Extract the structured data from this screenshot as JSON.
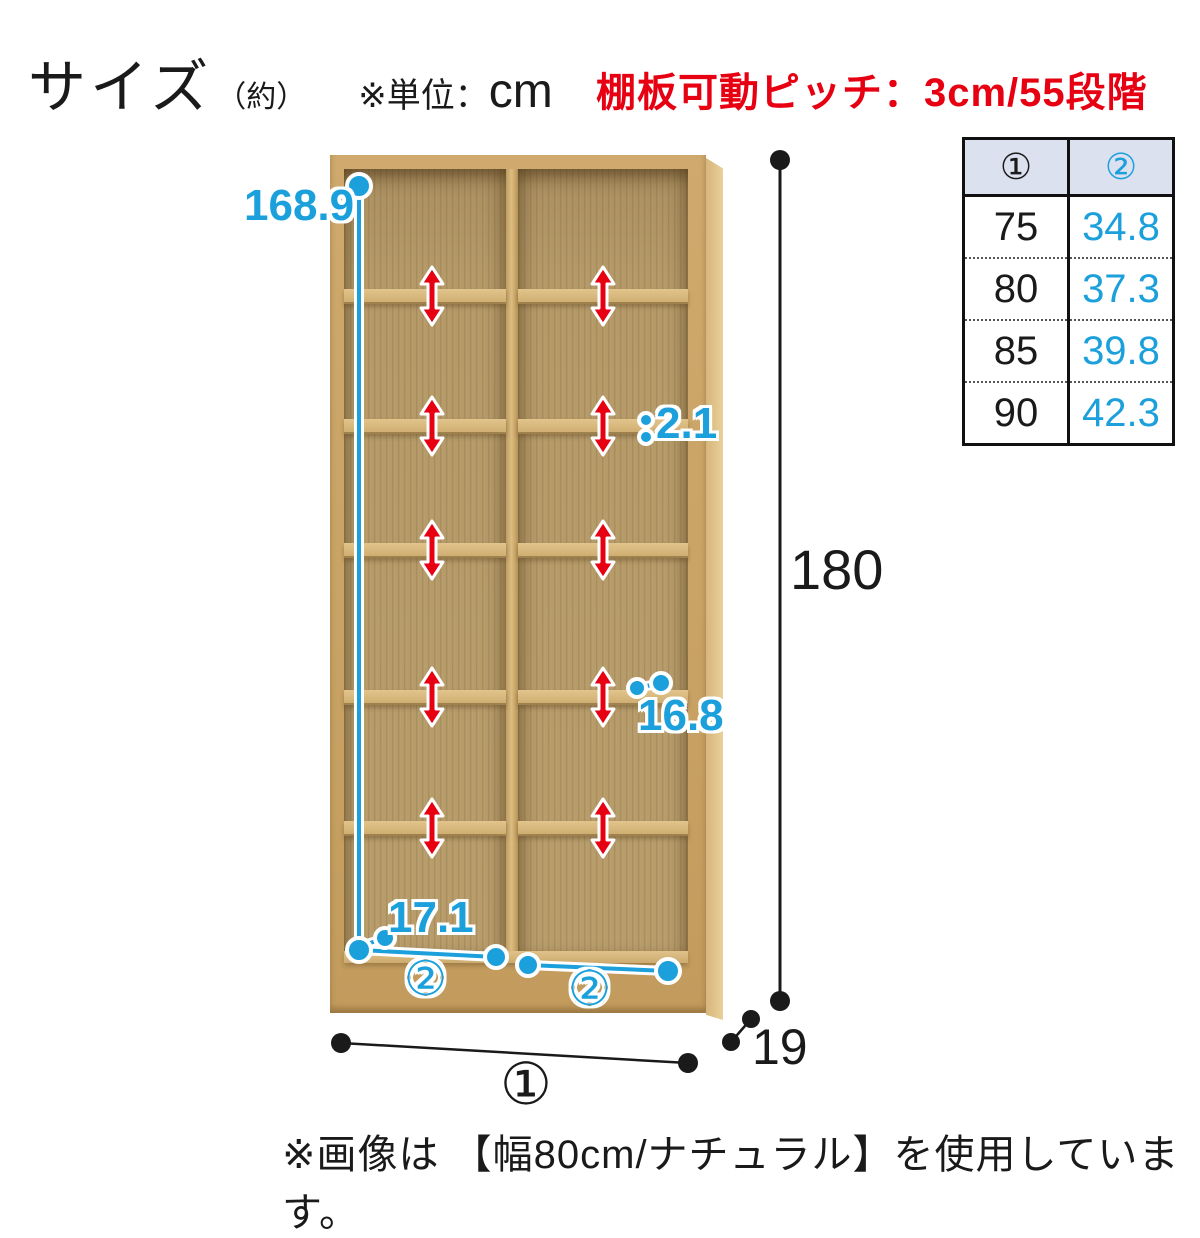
{
  "header": {
    "title": "サイズ",
    "title_approx": "（約）",
    "unit_prefix": "※単位：",
    "unit": "cm",
    "pitch_note": "棚板可動ピッチ：3cm/55段階"
  },
  "size_table": {
    "col1_header": "①",
    "col2_header": "②",
    "rows": [
      [
        "75",
        "34.8"
      ],
      [
        "80",
        "37.3"
      ],
      [
        "85",
        "39.8"
      ],
      [
        "90",
        "42.3"
      ]
    ]
  },
  "dimensions": {
    "interior_height": "168.9",
    "shelf_thickness": "2.1",
    "shelf_depth": "16.8",
    "bottom_interior_depth": "17.1",
    "inner_width_label_left": "②",
    "inner_width_label_right": "②",
    "total_height": "180",
    "total_width_label": "①",
    "total_depth": "19"
  },
  "caption": "※画像は 【幅80cm/ナチュラル】を使用しています。",
  "colors": {
    "annotation_blue": "#1ba0dc",
    "arrow_red": "#e60012",
    "note_red": "#e60012",
    "wood_frame": "#c9a365",
    "wood_interior": "#b89d6b",
    "table_header_bg": "#dce1f0",
    "text_black": "#1a1a1a"
  }
}
